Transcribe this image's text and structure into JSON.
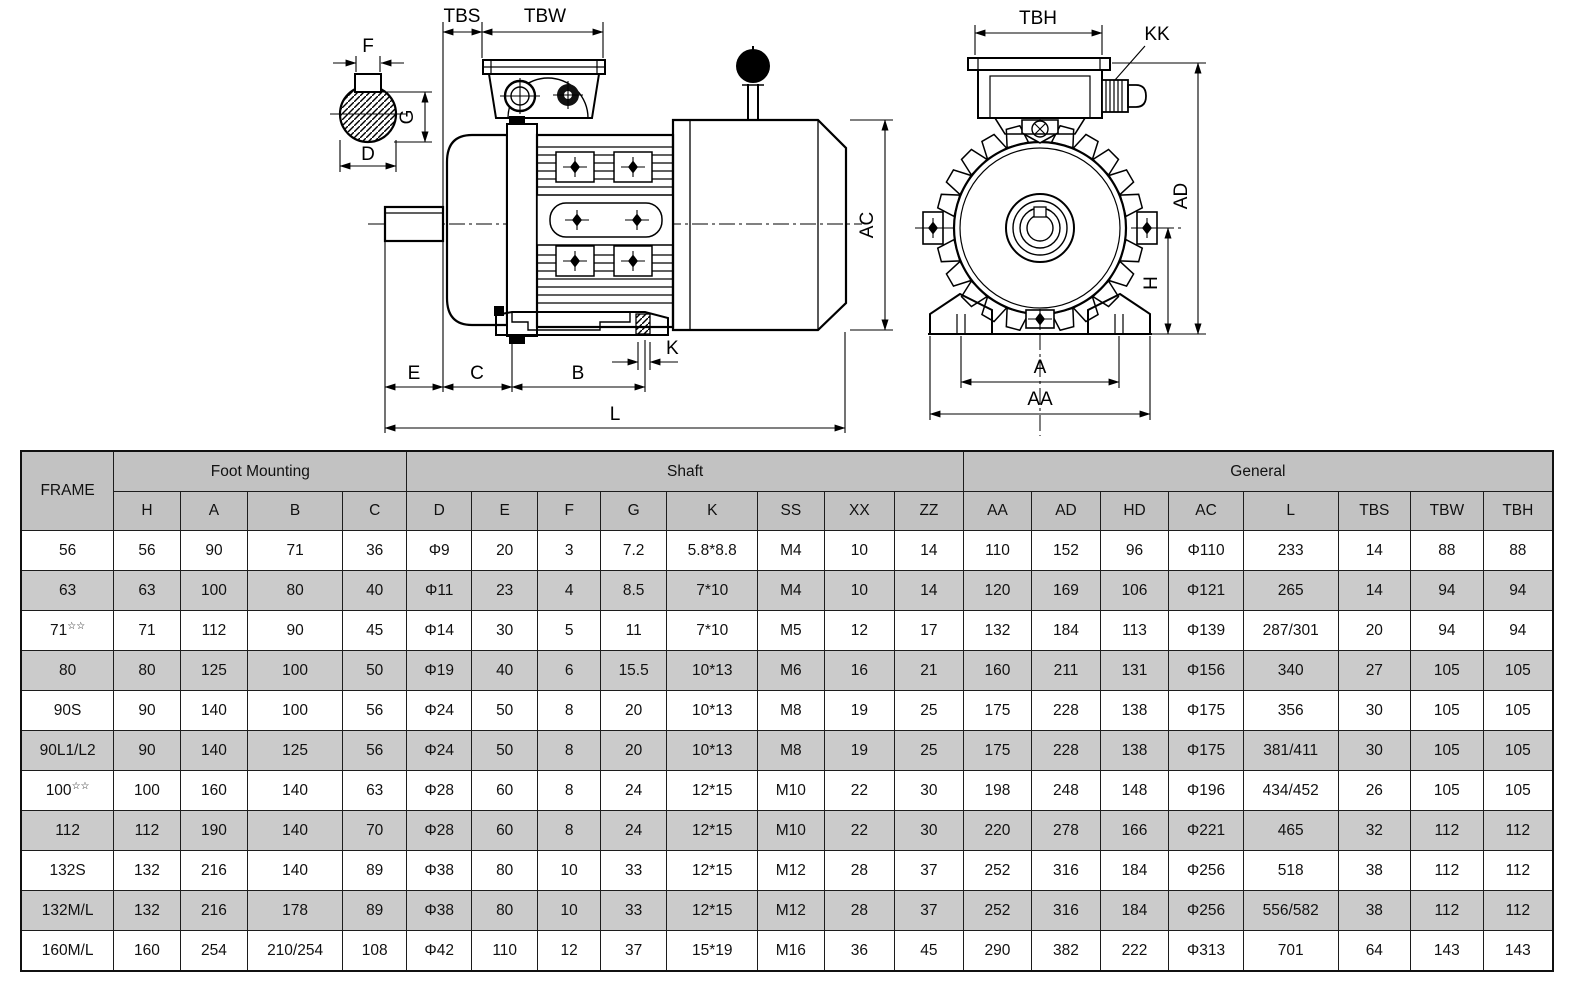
{
  "drawings": {
    "shaft_section": {
      "dim_f": "F",
      "dim_g": "G",
      "dim_d": "D"
    },
    "side_view": {
      "dim_tbs": "TBS",
      "dim_tbw": "TBW",
      "dim_ac": "AC",
      "dim_k": "K",
      "dim_e": "E",
      "dim_c": "C",
      "dim_b": "B",
      "dim_l": "L"
    },
    "front_view": {
      "dim_tbh": "TBH",
      "dim_kk": "KK",
      "dim_ad": "AD",
      "dim_h": "H",
      "dim_a": "A",
      "dim_aa": "AA"
    }
  },
  "table": {
    "frame_header": "FRAME",
    "groups": [
      {
        "label": "Foot Mounting",
        "cols": [
          "H",
          "A",
          "B",
          "C"
        ]
      },
      {
        "label": "Shaft",
        "cols": [
          "D",
          "E",
          "F",
          "G",
          "K",
          "SS",
          "XX",
          "ZZ"
        ]
      },
      {
        "label": "General",
        "cols": [
          "AA",
          "AD",
          "HD",
          "AC",
          "L",
          "TBS",
          "TBW",
          "TBH"
        ]
      }
    ],
    "rows": [
      {
        "frame": "56",
        "sup": "",
        "values": [
          "56",
          "90",
          "71",
          "36",
          "Φ9",
          "20",
          "3",
          "7.2",
          "5.8*8.8",
          "M4",
          "10",
          "14",
          "110",
          "152",
          "96",
          "Φ110",
          "233",
          "14",
          "88",
          "88"
        ]
      },
      {
        "frame": "63",
        "sup": "",
        "values": [
          "63",
          "100",
          "80",
          "40",
          "Φ11",
          "23",
          "4",
          "8.5",
          "7*10",
          "M4",
          "10",
          "14",
          "120",
          "169",
          "106",
          "Φ121",
          "265",
          "14",
          "94",
          "94"
        ]
      },
      {
        "frame": "71",
        "sup": "☆☆",
        "values": [
          "71",
          "112",
          "90",
          "45",
          "Φ14",
          "30",
          "5",
          "11",
          "7*10",
          "M5",
          "12",
          "17",
          "132",
          "184",
          "113",
          "Φ139",
          "287/301",
          "20",
          "94",
          "94"
        ]
      },
      {
        "frame": "80",
        "sup": "",
        "values": [
          "80",
          "125",
          "100",
          "50",
          "Φ19",
          "40",
          "6",
          "15.5",
          "10*13",
          "M6",
          "16",
          "21",
          "160",
          "211",
          "131",
          "Φ156",
          "340",
          "27",
          "105",
          "105"
        ]
      },
      {
        "frame": "90S",
        "sup": "",
        "values": [
          "90",
          "140",
          "100",
          "56",
          "Φ24",
          "50",
          "8",
          "20",
          "10*13",
          "M8",
          "19",
          "25",
          "175",
          "228",
          "138",
          "Φ175",
          "356",
          "30",
          "105",
          "105"
        ]
      },
      {
        "frame": "90L1/L2",
        "sup": "",
        "values": [
          "90",
          "140",
          "125",
          "56",
          "Φ24",
          "50",
          "8",
          "20",
          "10*13",
          "M8",
          "19",
          "25",
          "175",
          "228",
          "138",
          "Φ175",
          "381/411",
          "30",
          "105",
          "105"
        ]
      },
      {
        "frame": "100",
        "sup": "☆☆",
        "values": [
          "100",
          "160",
          "140",
          "63",
          "Φ28",
          "60",
          "8",
          "24",
          "12*15",
          "M10",
          "22",
          "30",
          "198",
          "248",
          "148",
          "Φ196",
          "434/452",
          "26",
          "105",
          "105"
        ]
      },
      {
        "frame": "112",
        "sup": "",
        "values": [
          "112",
          "190",
          "140",
          "70",
          "Φ28",
          "60",
          "8",
          "24",
          "12*15",
          "M10",
          "22",
          "30",
          "220",
          "278",
          "166",
          "Φ221",
          "465",
          "32",
          "112",
          "112"
        ]
      },
      {
        "frame": "132S",
        "sup": "",
        "values": [
          "132",
          "216",
          "140",
          "89",
          "Φ38",
          "80",
          "10",
          "33",
          "12*15",
          "M12",
          "28",
          "37",
          "252",
          "316",
          "184",
          "Φ256",
          "518",
          "38",
          "112",
          "112"
        ]
      },
      {
        "frame": "132M/L",
        "sup": "",
        "values": [
          "132",
          "216",
          "178",
          "89",
          "Φ38",
          "80",
          "10",
          "33",
          "12*15",
          "M12",
          "28",
          "37",
          "252",
          "316",
          "184",
          "Φ256",
          "556/582",
          "38",
          "112",
          "112"
        ]
      },
      {
        "frame": "160M/L",
        "sup": "",
        "values": [
          "160",
          "254",
          "210/254",
          "108",
          "Φ42",
          "110",
          "12",
          "37",
          "15*19",
          "M16",
          "36",
          "45",
          "290",
          "382",
          "222",
          "Φ313",
          "701",
          "64",
          "143",
          "143"
        ]
      }
    ]
  }
}
